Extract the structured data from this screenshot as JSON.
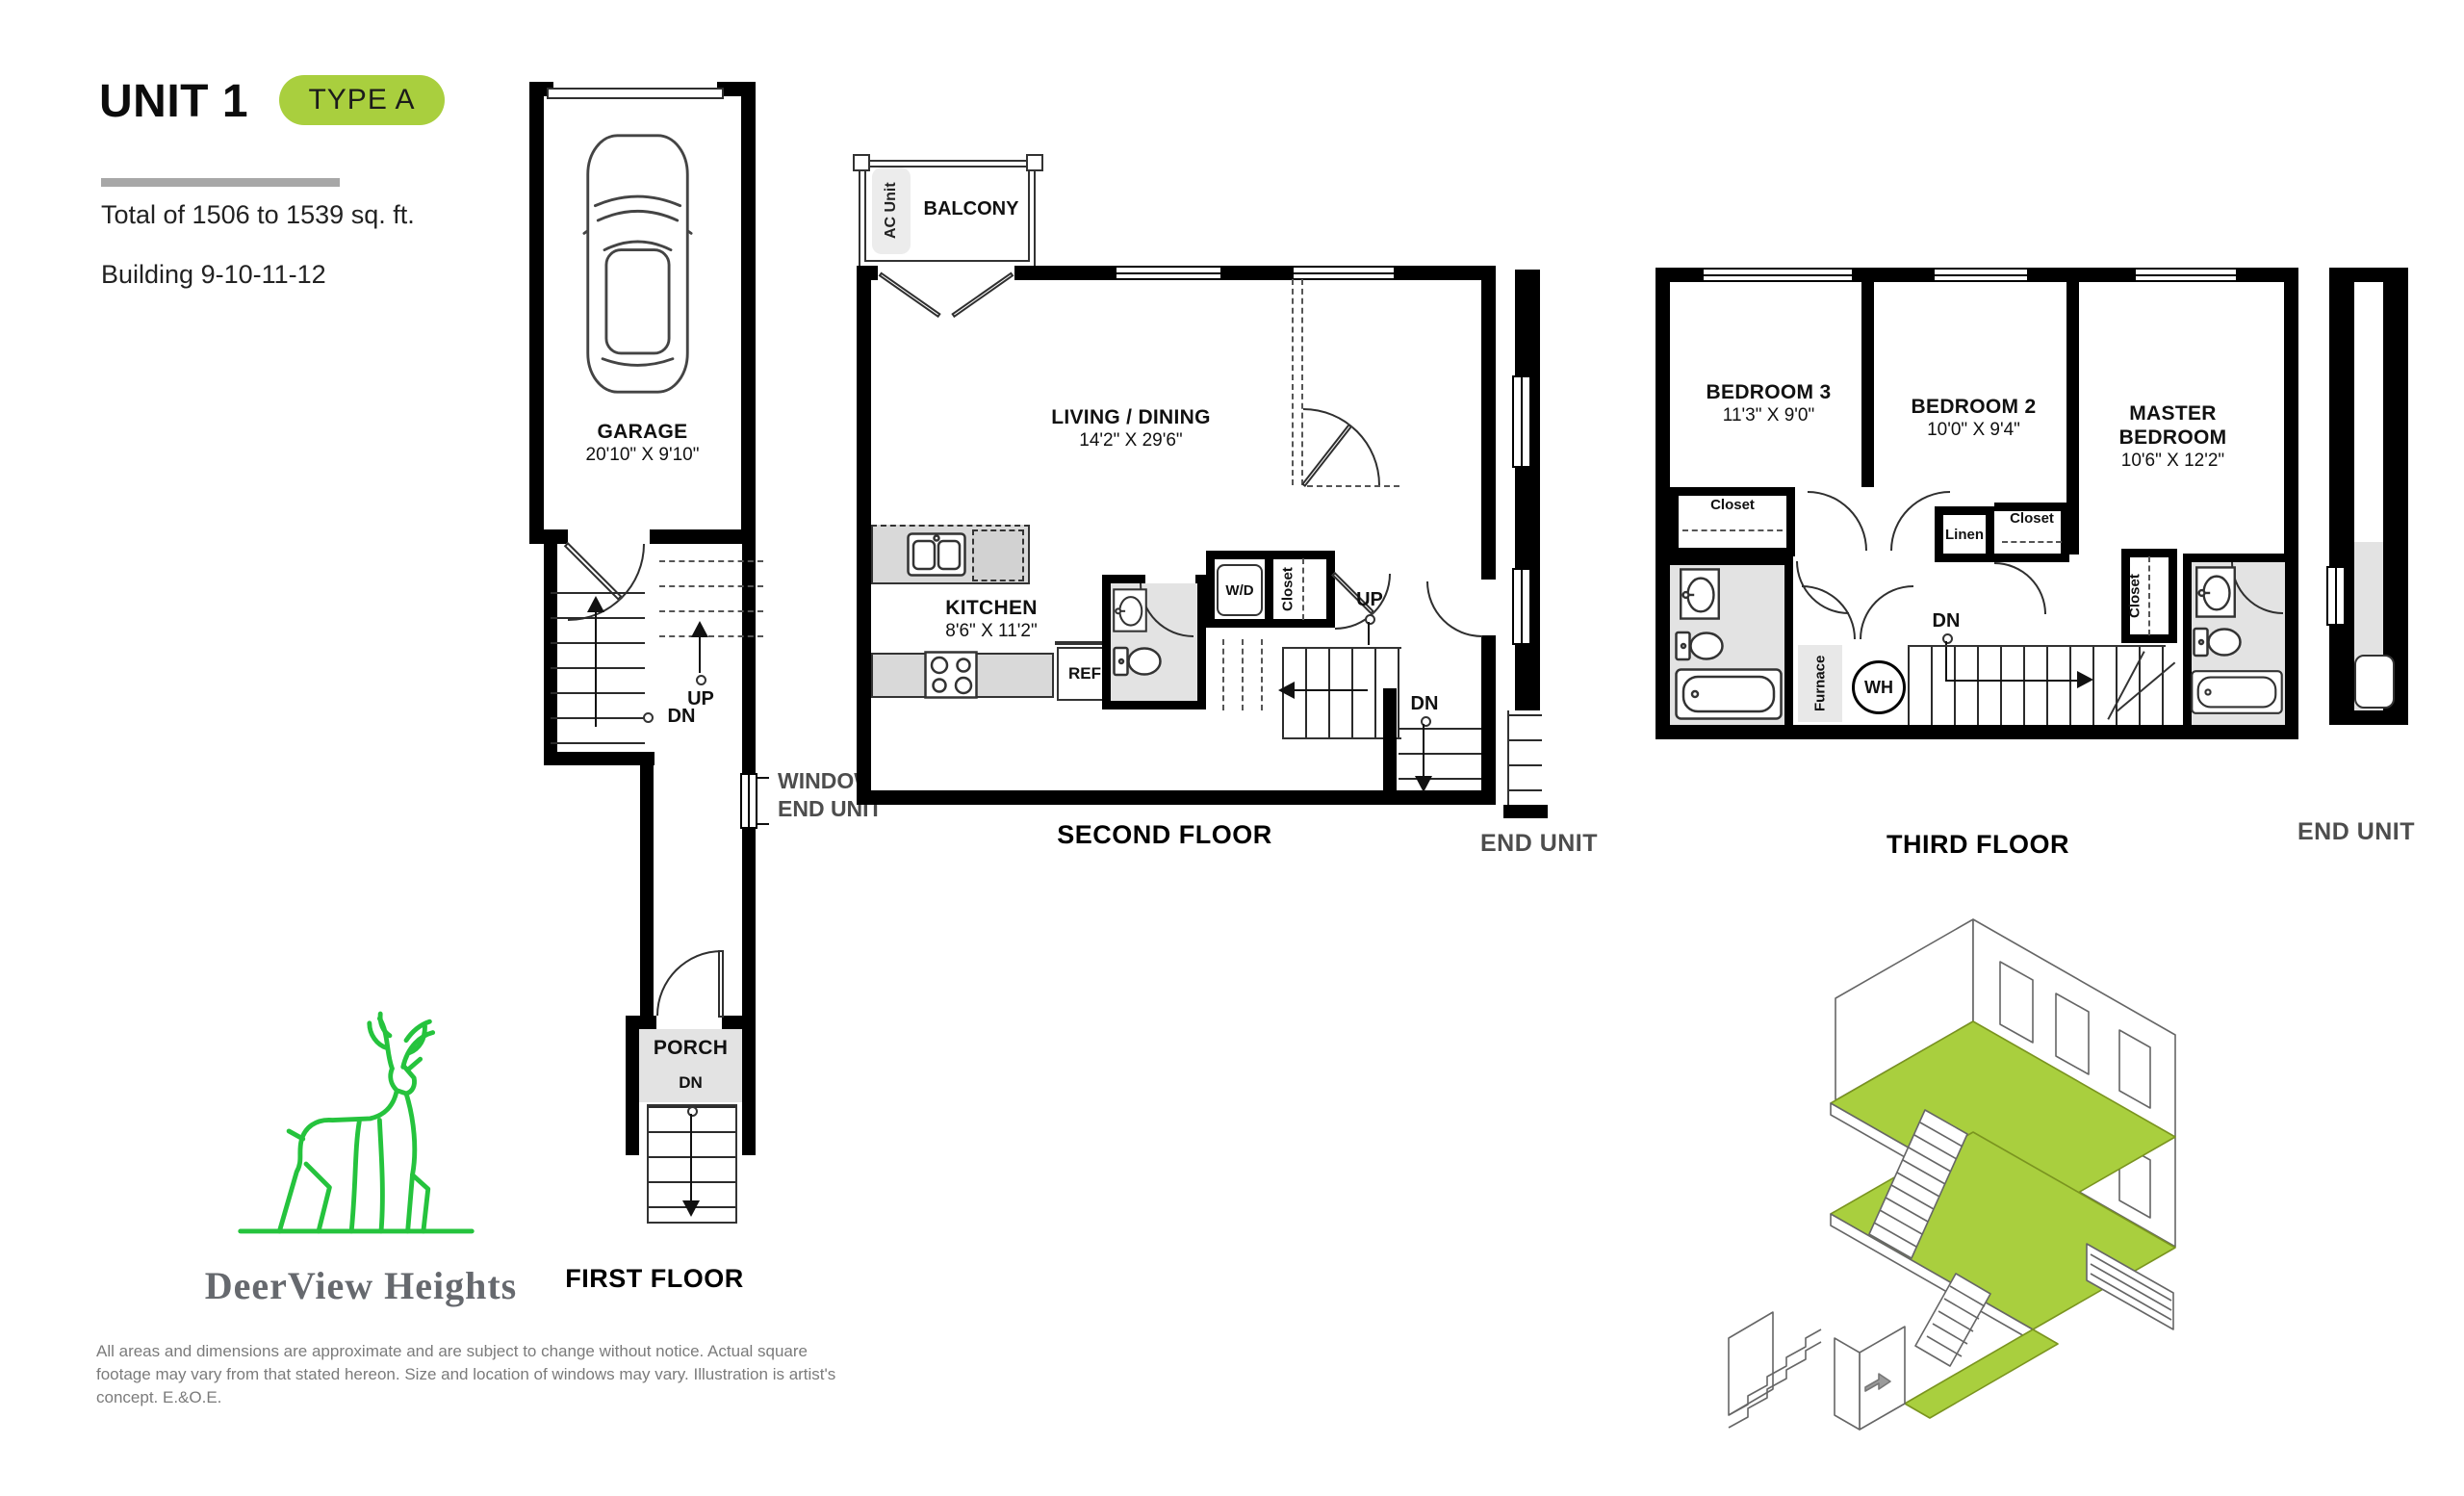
{
  "header": {
    "unit": "UNIT 1",
    "badge": "TYPE A",
    "total": "Total of 1506 to 1539 sq. ft.",
    "building": "Building 9-10-11-12"
  },
  "first_floor": {
    "title": "FIRST FLOOR",
    "garage_name": "GARAGE",
    "garage_dims": "20'10\" X 9'10\"",
    "up": "UP",
    "dn": "DN",
    "window_note": "WINDOW ON END UNIT",
    "porch": "PORCH",
    "porch_dn": "DN"
  },
  "second_floor": {
    "title": "SECOND FLOOR",
    "balcony": "BALCONY",
    "ac_unit": "AC Unit",
    "living_name": "LIVING / DINING",
    "living_dims": "14'2\" X 29'6\"",
    "kitchen_name": "KITCHEN",
    "kitchen_dims": "8'6\" X 11'2\"",
    "ref": "REF",
    "wd": "W/D",
    "closet": "Closet",
    "up": "UP",
    "dn": "DN",
    "end_unit": "END UNIT"
  },
  "third_floor": {
    "title": "THIRD FLOOR",
    "bedroom3_name": "BEDROOM 3",
    "bedroom3_dims": "11'3\" X 9'0\"",
    "bedroom2_name": "BEDROOM 2",
    "bedroom2_dims": "10'0\" X 9'4\"",
    "master_name": "MASTER BEDROOM",
    "master_dims": "10'6\" X 12'2\"",
    "closet_b3": "Closet",
    "closet_b2": "Closet",
    "closet_master": "Closet",
    "linen": "Linen",
    "furnace": "Furnace",
    "water_heater": "WH",
    "dn": "DN",
    "end_unit": "END UNIT"
  },
  "logo": {
    "brand": "DeerView Heights"
  },
  "disclaimer": "All areas and dimensions are approximate and are subject to change without notice. Actual square footage may vary from that stated hereon. Size and location of windows may vary. Illustration is artist's concept. E.&O.E.",
  "colors": {
    "accent_badge": "#a9cf3e",
    "iso_floor_green": "#a9cf3e",
    "logo_green": "#25c33d",
    "wall_black": "#000000",
    "room_gray": "#e3e3e3",
    "muted_label_gray": "#4d4d4d"
  }
}
